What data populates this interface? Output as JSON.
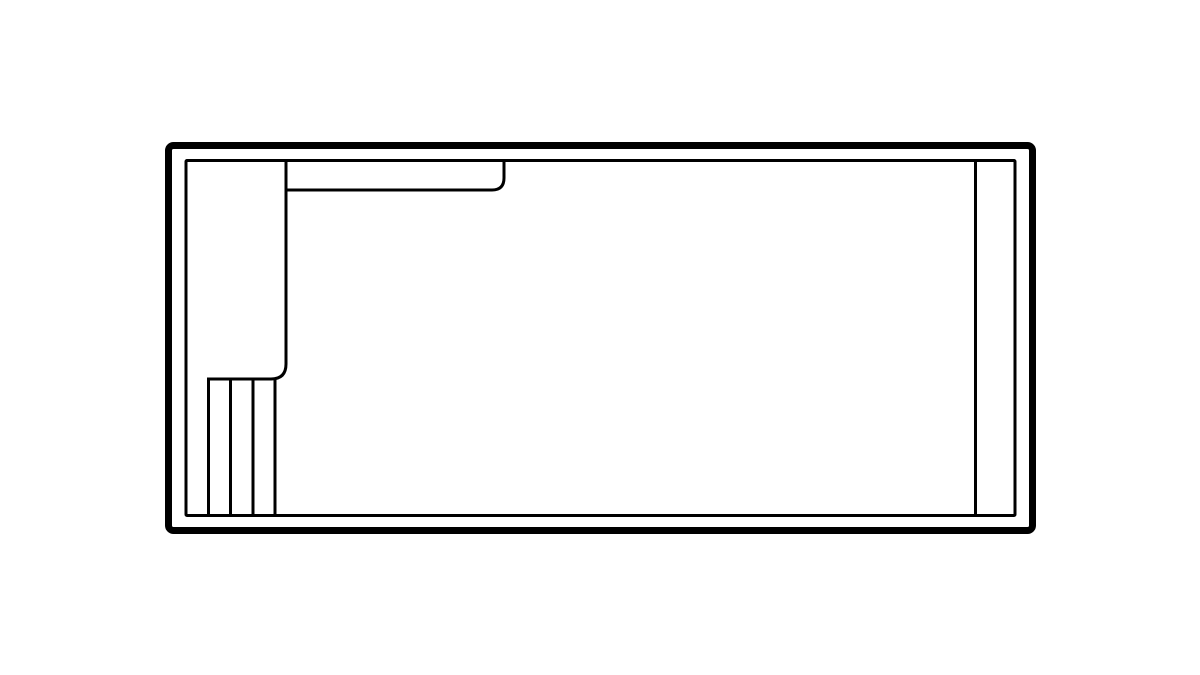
{
  "diagram": {
    "title": "rectangular-pool-floor-plan",
    "background_color": "#ffffff",
    "stroke_color": "#000000",
    "canvas": {
      "width": 1200,
      "height": 675
    },
    "shapes": [
      {
        "name": "pool-outer-coping-rect",
        "type": "rect",
        "x": 168.5,
        "y": 145.5,
        "width": 864,
        "height": 385,
        "rx": 5,
        "stroke_width": 7
      },
      {
        "name": "pool-waterline-rect",
        "type": "rect",
        "x": 186,
        "y": 160.5,
        "width": 829,
        "height": 355,
        "rx": 1,
        "stroke_width": 3
      },
      {
        "name": "tanning-ledge-and-steps-outline",
        "type": "path",
        "d": "M 286 160.5 L 286 364 Q 286 379 271 379 L 208.5 379 L 208.5 516",
        "stroke_width": 3
      },
      {
        "name": "step-riser-line-1",
        "type": "line",
        "x1": 230.5,
        "y1": 379,
        "x2": 230.5,
        "y2": 516,
        "stroke_width": 3
      },
      {
        "name": "step-riser-line-2",
        "type": "line",
        "x1": 253,
        "y1": 379,
        "x2": 253,
        "y2": 516,
        "stroke_width": 3
      },
      {
        "name": "step-riser-line-3",
        "type": "line",
        "x1": 275,
        "y1": 379,
        "x2": 275,
        "y2": 516,
        "stroke_width": 3
      },
      {
        "name": "top-bench-edge",
        "type": "path",
        "d": "M 286 190 L 492 190 Q 504 190 504 178 L 504 160.5",
        "stroke_width": 3
      },
      {
        "name": "right-bench-edge",
        "type": "line",
        "x1": 975.5,
        "y1": 160.5,
        "x2": 975.5,
        "y2": 516,
        "stroke_width": 3
      }
    ]
  }
}
